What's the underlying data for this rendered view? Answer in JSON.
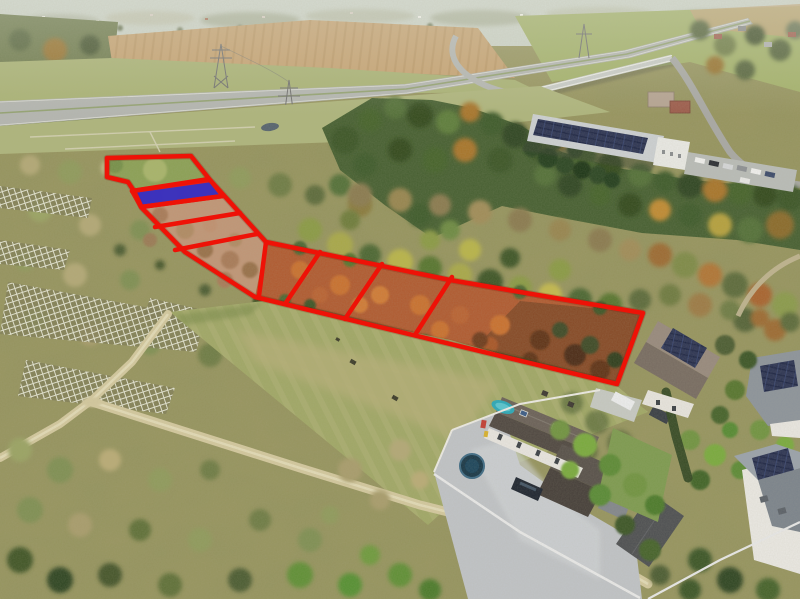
{
  "meta": {
    "media_type": "aerial-drone-photograph",
    "subject": "vacant land parcels outlined for sale",
    "width": 800,
    "height": 599
  },
  "overlay": {
    "outline_color": "#ee1207",
    "outline_width": 4.5,
    "parcel_count": 9,
    "highlighted_parcel": {
      "fill": "#2f28c4",
      "opacity": 0.9
    }
  },
  "palette": {
    "sky_haze": "#ccd2c6",
    "field_tan": "#c6a271",
    "verge_green": "#a9b274",
    "highway_gray": "#b4b6b2",
    "forest_green": "#465f31",
    "scrub_olive": "#98955f",
    "rust_soil": "#b05a30",
    "soil_pink": "#c09576",
    "meadow_green": "#a0a766",
    "paving_gray": "#c0c3c7",
    "solar_navy": "#2b3353",
    "hedge_dark": "#35491f",
    "dirt_road": "#d3c89e"
  },
  "scene_features": [
    "highway-interchange",
    "overpass-bridge",
    "power-pylons",
    "warehouse-solar-roof",
    "parking-lot",
    "forest-band",
    "greenhouse-frame-rows",
    "parcel-strip",
    "sold-plot-blue",
    "meadow-field",
    "dirt-roads",
    "residential-houses",
    "gardens"
  ]
}
